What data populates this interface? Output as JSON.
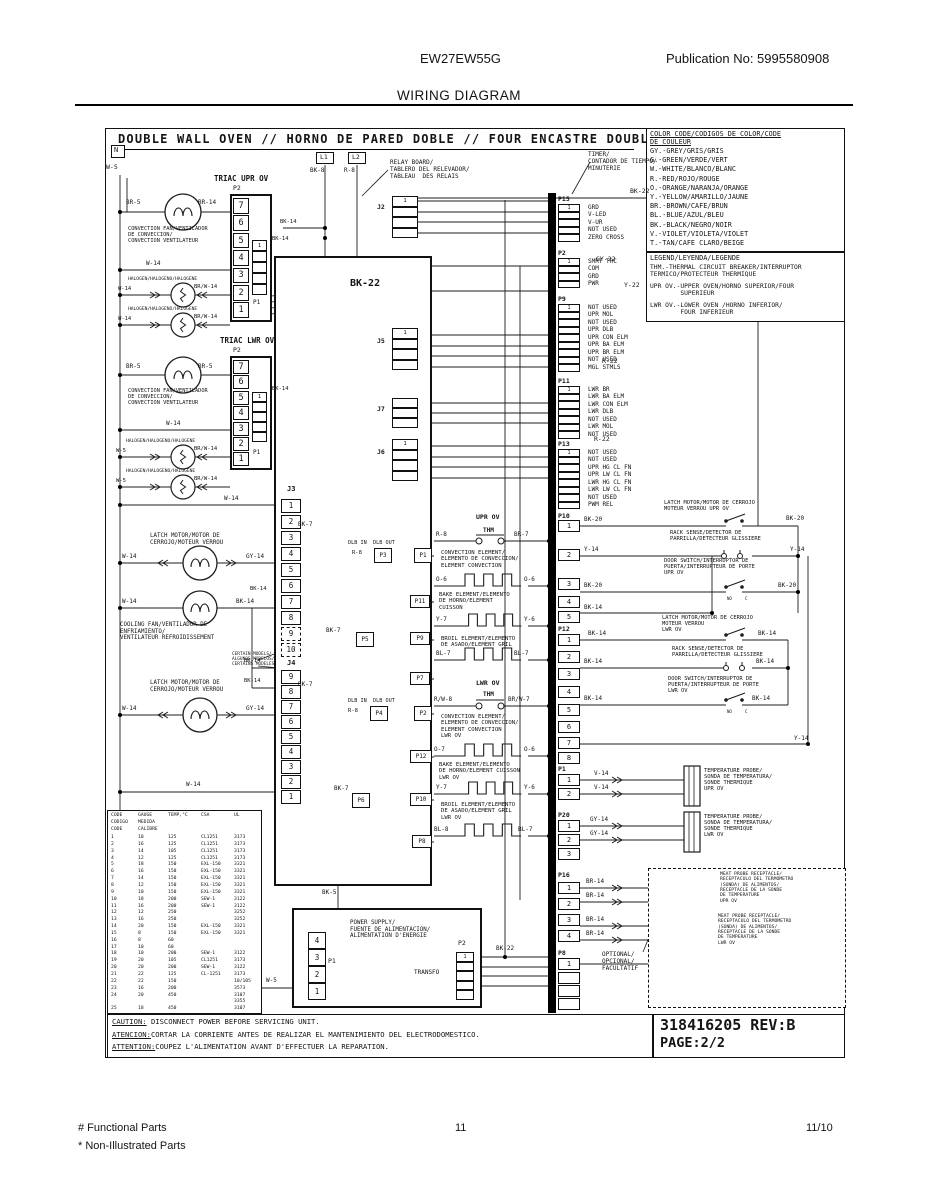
{
  "header": {
    "model": "EW27EW55G",
    "publication": "Publication No: 5995580908",
    "title": "WIRING DIAGRAM"
  },
  "footer": {
    "functional": "# Functional Parts",
    "non_illustrated": "* Non-Illustrated Parts",
    "page_number": "11",
    "date": "11/10"
  },
  "diagram": {
    "title": "DOUBLE WALL OVEN // HORNO DE PARED DOBLE // FOUR ENCASTRE DOUBLE",
    "n": "N",
    "part_number": "318416205 REV:B",
    "page": "PAGE:2/2",
    "caution_lines": [
      "CAUTION: DISCONNECT POWER BEFORE SERVICING UNIT.",
      "ATENCION:CORTAR LA CORRIENTE ANTES DE REALIZAR EL MANTENIMIENTO DEL ELECTRODOMESTICO.",
      "ATTENTION:COUPEZ L'ALIMENTATION AVANT D'EFFECTUER LA REPARATION."
    ]
  },
  "color_code": {
    "title": "COLOR CODE/CODIGOS DE COLOR/CODE\nDE COULEUR",
    "entries": [
      "GY.-GREY/GRIS/GRIS",
      "G.-GREEN/VERDE/VERT",
      "W.-WHITE/BLANCO/BLANC",
      "R.-RED/ROJO/ROUGE",
      "O.-ORANGE/NARANJA/ORANGE",
      "Y.-YELLOW/AMARILLO/JAUNE",
      "BR.-BROWN/CAFE/BRUN",
      "BL.-BLUE/AZUL/BLEU",
      "BK.-BLACK/NEGRO/NOIR",
      "V.-VIOLET/VIOLETA/VIOLET",
      "T.-TAN/CAFE CLARO/BEIGE"
    ]
  },
  "legend": {
    "title": "LEGEND/LEYENDA/LEGENDE",
    "entries": [
      "THM.-THERMAL CIRCUIT BREAKER/INTERRUPTOR\nTERMICO/PROTECTEUR THERMIQUE",
      "UPR OV.-UPPER OVEN/HORNO SUPERIOR/FOUR\n        SUPERIEUR",
      "LWR OV.-LOWER OVEN /HORNO INFERIOR/\n        FOUR INFERIEUR"
    ]
  },
  "wires": {
    "w5": "W-5",
    "w14": "W-14",
    "bk5": "BK-5",
    "bk7": "BK-7",
    "bk8": "BK-8",
    "bk14": "BK-14",
    "bk20": "BK-20",
    "bk22": "BK-22",
    "r8": "R-8",
    "rw8": "R/W-8",
    "r22": "R-22",
    "br5": "BR-5",
    "br7": "BR-7",
    "br14": "BR-14",
    "brw7": "BR/W-7",
    "brw14": "BR/W-14",
    "gy14": "GY-14",
    "gy22": "GY-22",
    "y6": "Y-6",
    "y7": "Y-7",
    "y14": "Y-14",
    "y22": "Y-22",
    "o6": "O-6",
    "o7": "O-7",
    "bl7": "BL-7",
    "bl8": "BL-8",
    "v14": "V-14",
    "l1": "L1",
    "l2": "L2"
  },
  "triac_upper": {
    "title": "TRIAC UPR OV",
    "p2": "P2",
    "p1": "P1",
    "pins": [
      "7",
      "6",
      "5",
      "4",
      "3",
      "2",
      "1"
    ],
    "inner": [
      "1",
      "",
      "",
      "",
      ""
    ]
  },
  "triac_lower": {
    "title": "TRIAC LWR OV",
    "p2": "P2",
    "p1": "P1",
    "pins": [
      "7",
      "6",
      "5",
      "4",
      "3",
      "2",
      "1"
    ],
    "inner": [
      "1",
      "",
      "",
      "",
      ""
    ]
  },
  "relay_board": {
    "label": "RELAY BOARD/\nTABLERO DEL RELEVADOR/\nTABLEAU  DES RELAIS",
    "bk22_big": "BK-22",
    "dlb_header": "DLB IN  DLB OUT",
    "j2": "J2",
    "j5": "J5",
    "j7": "J7",
    "j6": "J6",
    "j3": "J3",
    "j4": "J4",
    "j2_pins": [
      "1",
      "",
      "",
      ""
    ],
    "j5_pins": [
      "1",
      "",
      "",
      ""
    ],
    "j7_pins": [
      "",
      "",
      ""
    ],
    "j6_pins": [
      "1",
      "",
      "",
      ""
    ],
    "j3_pins": [
      "1",
      "2",
      "3",
      "4",
      "5",
      "6",
      "7",
      "8",
      "9",
      "10"
    ],
    "j4_pins": [
      "9",
      "8",
      "7",
      "6",
      "5",
      "4",
      "3",
      "2",
      "1"
    ],
    "ports": {
      "p3": "P3",
      "p1": "P1",
      "p11": "P11",
      "p5": "P5",
      "p9": "P9",
      "p7": "P7",
      "p4": "P4",
      "p2": "P2",
      "p12": "P12",
      "p6": "P6",
      "p10": "P10",
      "p8": "P8"
    }
  },
  "timer": {
    "label": "TIMER/\nCONTADOR DE TIEMPO/\nMINUTERIE",
    "signal_groups": [
      {
        "name": "P15",
        "signals": [
          "GRD",
          "V-LED",
          "V-UR",
          "NOT USED",
          "ZERO CROSS"
        ]
      },
      {
        "name": "P2",
        "signals": [
          "SMRT TRC",
          "COM",
          "GRD",
          "PWR"
        ]
      },
      {
        "name": "P9",
        "signals": [
          "NOT USED",
          "UPR MOL",
          "NOT USED",
          "UPR DLB",
          "UPR CON ELM",
          "UPR BA ELM",
          "UPR BR ELM",
          "NOT USED",
          "MGL STMLS"
        ]
      },
      {
        "name": "P11",
        "signals": [
          "LWR BR",
          "LWR BA ELM",
          "LWR CON ELM",
          "LWR DLB",
          "NOT USED",
          "LWR MOL",
          "NOT USED"
        ]
      },
      {
        "name": "P13",
        "signals": [
          "NOT USED",
          "NOT USED",
          "UPR HG CL FN",
          "UPR LW CL FN",
          "LWR HG CL FN",
          "LWR LW CL FN",
          "NOT USED",
          "PWM REL"
        ]
      }
    ],
    "pin_groups": [
      {
        "name": "P10",
        "pins": [
          "1",
          "2",
          "3",
          "4",
          "5"
        ]
      },
      {
        "name": "P12",
        "pins": [
          "1",
          "2",
          "3",
          "4",
          "5",
          "6",
          "7",
          "8"
        ]
      },
      {
        "name": "P1",
        "pins": [
          "1",
          "2"
        ]
      },
      {
        "name": "P20",
        "pins": [
          "1",
          "2",
          "3"
        ]
      },
      {
        "name": "P16",
        "pins": [
          "1",
          "2",
          "3",
          "4"
        ]
      },
      {
        "name": "P8",
        "pins": [
          "1",
          "",
          "",
          ""
        ]
      }
    ]
  },
  "elements_upper": {
    "section": "UPR OV",
    "thm": "THM",
    "lw": "R-8",
    "rw": "BR-7",
    "items": [
      {
        "label": "CONVECTION ELEMENT/\nELEMENTO DE CONVECCION/\nELEMENT CONVECTION",
        "l": "O-6",
        "r": "O-6"
      },
      {
        "label": "BAKE ELEMENT/ELEMENTO\nDE HORNO/ELEMENT\nCUISSON",
        "l": "Y-7",
        "r": "Y-6"
      },
      {
        "label": "BROIL ELEMENT/ELEMENTO\nDE ASADO/ELEMENT GRIL",
        "l": "BL-7",
        "r": "BL-7"
      }
    ]
  },
  "elements_lower": {
    "section": "LWR OV",
    "thm": "THM",
    "lw": "R/W-8",
    "rw": "BR/W-7",
    "items": [
      {
        "label": "CONVECTION ELEMENT/\nELEMENTO DE CONVECCION/\nELEMENT CONVECTION\nLWR OV",
        "l": "O-7",
        "r": "O-6"
      },
      {
        "label": "BAKE ELEMENT/ELEMENTO\nDE HORNO/ELEMENT CUISSON\nLWR OV",
        "l": "Y-7",
        "r": "Y-6"
      },
      {
        "label": "BROIL ELEMENT/ELEMENTO\nDE ASADO/ELEMENT GRIL\nLWR OV",
        "l": "BL-8",
        "r": "BL-7"
      }
    ]
  },
  "components": {
    "conv_fan": "CONVECTION FAN/VENTILADOR\nDE CONVECCION/\nCONVECTION VENTILATEUR",
    "halogen": "HALOGEN/HALOGENO/HALOGENE",
    "latch_motor": "LATCH MOTOR/MOTOR DE\nCERROJO/MOTEUR VERROU",
    "cooling_fan": "COOLING FAN/VENTILADOR DE\nENFRIAMIENTO/\nVENTILATEUR REFROIDISSEMENT",
    "certain_models": "CERTAIN MODELS/\nALGUNOS MODELOS/\nCERTAINS MODELES",
    "latch_upr": "LATCH MOTOR/MOTOR DE CERROJO\nMOTEUR VERROU UPR OV",
    "rack_sense": "RACK SENSE/DETECTOR DE\nPARRILLA/DETECTEUR GLISSIERE",
    "door_upr": "DOOR SWITCH/INTERRUPTOR DE\nPUERTA/INTERRUPTEUR DE PORTE\nUPR OV",
    "latch_lwr": "LATCH MOTOR/MOTOR DE CERROJO\nMOTEUR VERROU\nLWR OV",
    "door_lwr": "DOOR SWITCH/INTERRUPTOR DE\nPUERTA/INTERRUPTEUR DE PORTE\nLWR OV",
    "temp_upr": "TEMPERATURE PROBE/\nSONDA DE TEMPERATURA/\nSONDE THERMIQUE\nUPR OV",
    "temp_lwr": "TEMPERATURE PROBE/\nSONDA DE TEMPERATURA/\nSONDE THERMIQUE\nLWR OV",
    "meat_upr": "MEAT PROBE RECEPTACLE/\nRECEPTACULO DEL TERMOMETRO\n(SONDA) DE ALIMENTOS/\nRECEPTACLE DE LA SONDE\nDE TEMPERATURE\nUPR OV",
    "meat_lwr": "MEAT PROBE RECEPTACLE/\nRECEPTACULO DEL TERMOMETRO\n(SONDA) DE ALIMENTOS/\nRECEPTACLE DE LA SONDE\nDE TEMPERATURE\nLWR OV",
    "optional": "OPTIONAL/\nOPCIONAL/\nFACULTATIF",
    "no": "NO",
    "c": "C"
  },
  "power_supply": {
    "label": "POWER SUPPLY/\nFUENTE DE ALIMENTACION/\nALIMENTATION D'ENERGIE",
    "p1": "P1",
    "p2": "P2",
    "transfo": "TRANSFO",
    "p1_pins": [
      "4",
      "3",
      "2",
      "1"
    ],
    "p2_pins": [
      "1",
      "",
      "",
      "",
      ""
    ]
  },
  "wire_table": {
    "header_lines": [
      [
        "CODE",
        "GAUGE",
        "TEMP,°C",
        "CSA",
        "UL"
      ],
      [
        "CODIGO",
        "MEDIDA",
        "",
        "",
        ""
      ],
      [
        "CODE",
        "CALIBRE",
        "",
        "",
        ""
      ]
    ],
    "rows": [
      [
        "1",
        "18",
        "125",
        "CL1251",
        "3173"
      ],
      [
        "2",
        "16",
        "125",
        "CL1251",
        "3173"
      ],
      [
        "3",
        "14",
        "105",
        "CL1251",
        "3173"
      ],
      [
        "4",
        "12",
        "125",
        "CL1251",
        "3173"
      ],
      [
        "5",
        "18",
        "150",
        "EXL-150",
        "3321"
      ],
      [
        "6",
        "16",
        "150",
        "EXL-150",
        "3321"
      ],
      [
        "7",
        "14",
        "150",
        "EXL-150",
        "3321"
      ],
      [
        "8",
        "12",
        "150",
        "EXL-150",
        "3321"
      ],
      [
        "9",
        "10",
        "150",
        "EXL-150",
        "3321"
      ],
      [
        "10",
        "18",
        "200",
        "SEW-1",
        "3122"
      ],
      [
        "11",
        "16",
        "200",
        "SEW-1",
        "3122"
      ],
      [
        "12",
        "12",
        "250",
        "",
        "3252"
      ],
      [
        "13",
        "16",
        "250",
        "",
        "3252"
      ],
      [
        "14",
        "20",
        "150",
        "EXL-150",
        "3321"
      ],
      [
        "15",
        "8",
        "150",
        "EXL-150",
        "3321"
      ],
      [
        "16",
        "8",
        "60",
        "",
        ""
      ],
      [
        "17",
        "10",
        "60",
        "",
        ""
      ],
      [
        "18",
        "10",
        "200",
        "SEW-1",
        "3122"
      ],
      [
        "19",
        "20",
        "105",
        "CL1251",
        "3173"
      ],
      [
        "20",
        "20",
        "200",
        "SEW-1",
        "3122"
      ],
      [
        "21",
        "22",
        "125",
        "CL-1251",
        "3173"
      ],
      [
        "22",
        "22",
        "150",
        "",
        "10/105"
      ],
      [
        "23",
        "16",
        "200",
        "",
        "3573"
      ],
      [
        "24",
        "20",
        "450",
        "",
        "3107"
      ],
      [
        "",
        "",
        "",
        "",
        "3355"
      ],
      [
        "25",
        "18",
        "450",
        "",
        "3107"
      ]
    ]
  }
}
